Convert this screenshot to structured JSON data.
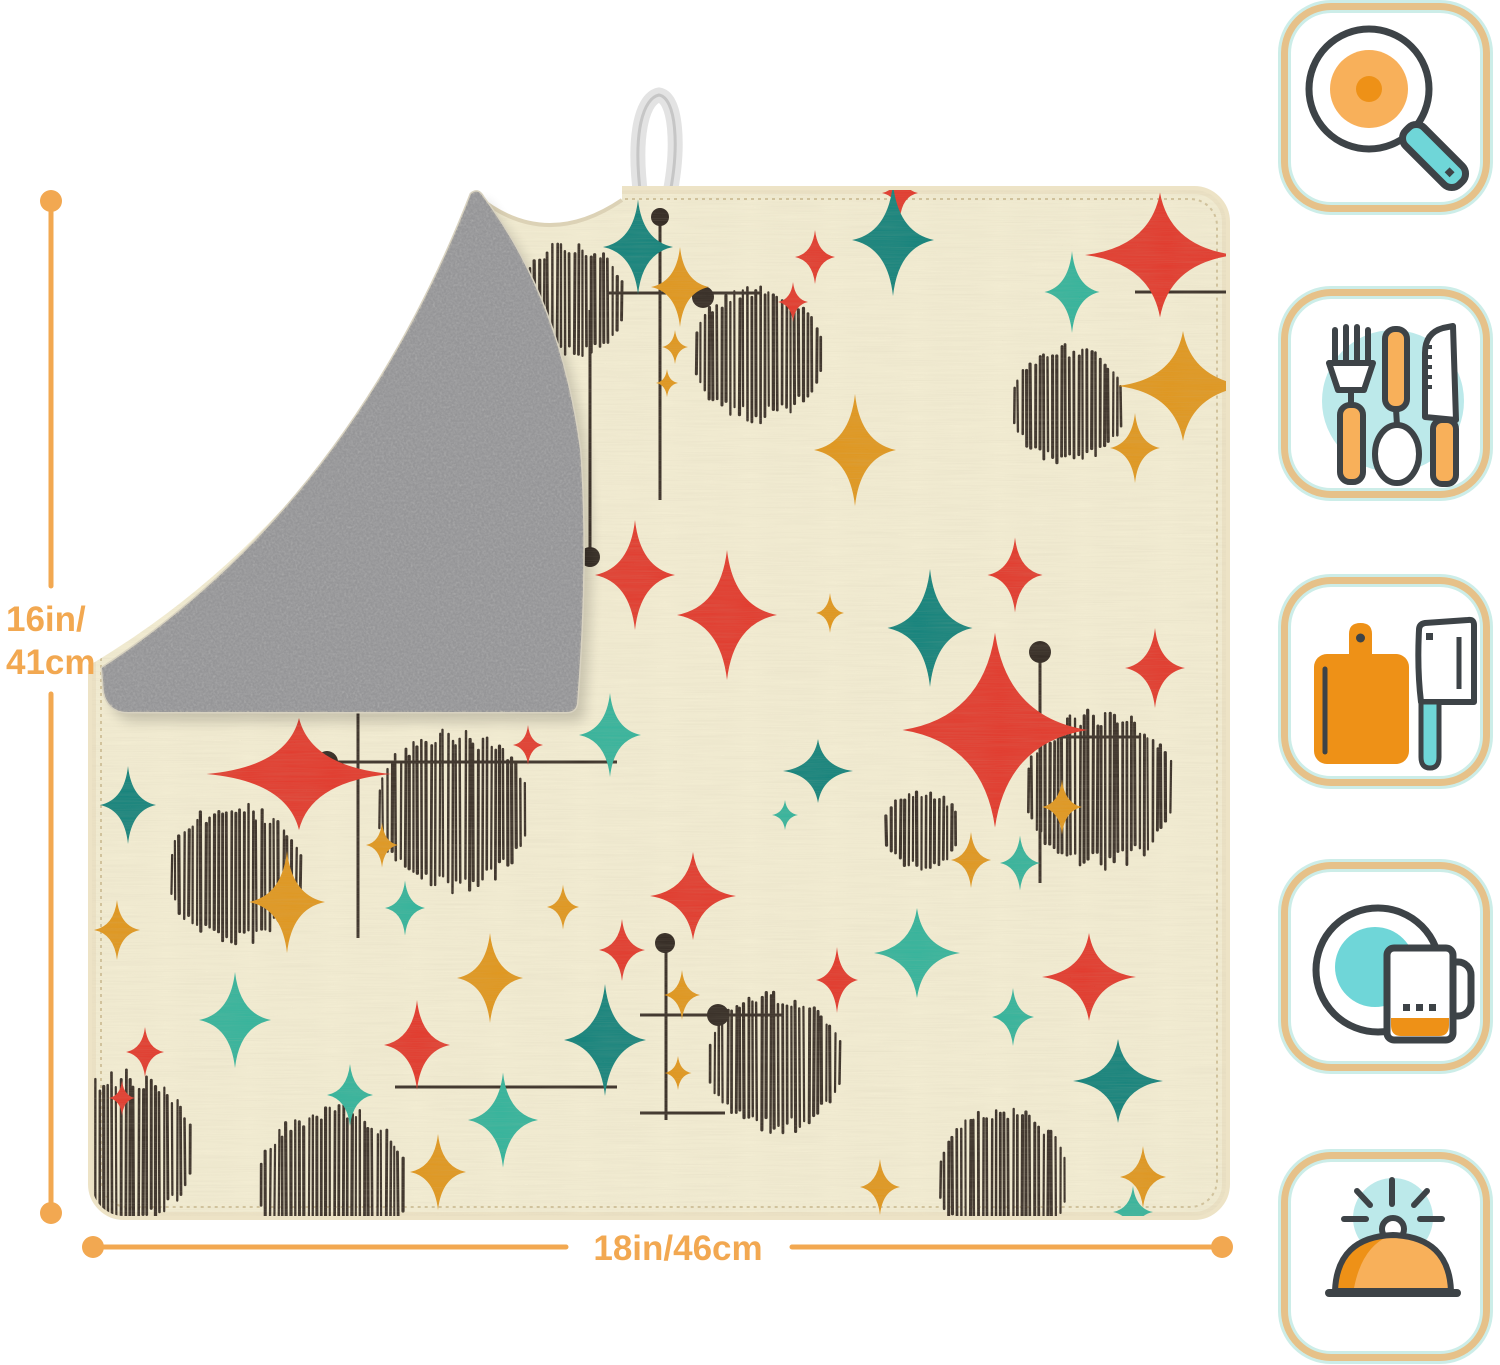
{
  "dimensions": {
    "height": {
      "line1": "16in/",
      "line2": "41cm"
    },
    "width": {
      "label": "18in/46cm"
    }
  },
  "colors": {
    "page_bg": "#FFFFFF",
    "dimension": "#F2A851",
    "mat_front": "#F3EDD3",
    "mat_edge": "#EDE3C6",
    "mat_stitch": "#C9B88E",
    "mat_back": "#B4B4B4",
    "loop": "#E3E3E3",
    "badge_border": "#E6C189",
    "badge_glow": "#CCEDE8",
    "icon_dark": "#3D4347",
    "icon_orange": "#EE9117",
    "icon_orange_light": "#F8B05A",
    "icon_teal": "#6FD6D8",
    "icon_teal_light": "#BCE9EA"
  },
  "pattern": {
    "colors": {
      "r": "#E23B2E",
      "t": "#15837C",
      "m": "#35B49C",
      "o": "#E0971F",
      "ink": "#3A3028",
      "dot": "#332A23"
    },
    "stars": [
      [
        638,
        247,
        70,
        95,
        "t"
      ],
      [
        900,
        193,
        36,
        50,
        "r"
      ],
      [
        815,
        257,
        40,
        54,
        "r"
      ],
      [
        793,
        302,
        30,
        40,
        "r"
      ],
      [
        893,
        240,
        82,
        112,
        "t"
      ],
      [
        1072,
        292,
        55,
        82,
        "m"
      ],
      [
        1160,
        255,
        150,
        125,
        "r"
      ],
      [
        1183,
        386,
        130,
        110,
        "o"
      ],
      [
        1135,
        448,
        50,
        70,
        "o"
      ],
      [
        855,
        450,
        82,
        112,
        "o"
      ],
      [
        680,
        287,
        58,
        80,
        "o"
      ],
      [
        675,
        347,
        26,
        34,
        "o"
      ],
      [
        667,
        383,
        22,
        28,
        "o"
      ],
      [
        635,
        575,
        80,
        110,
        "r"
      ],
      [
        727,
        615,
        100,
        130,
        "r"
      ],
      [
        830,
        613,
        28,
        40,
        "o"
      ],
      [
        930,
        628,
        85,
        118,
        "t"
      ],
      [
        1015,
        575,
        55,
        75,
        "r"
      ],
      [
        1155,
        668,
        60,
        80,
        "r"
      ],
      [
        299,
        774,
        185,
        112,
        "r"
      ],
      [
        128,
        805,
        56,
        78,
        "t"
      ],
      [
        117,
        930,
        46,
        60,
        "o"
      ],
      [
        287,
        902,
        76,
        102,
        "o"
      ],
      [
        382,
        845,
        32,
        45,
        "o"
      ],
      [
        405,
        908,
        40,
        55,
        "m"
      ],
      [
        528,
        745,
        30,
        40,
        "r"
      ],
      [
        610,
        735,
        62,
        84,
        "m"
      ],
      [
        563,
        907,
        32,
        45,
        "o"
      ],
      [
        490,
        978,
        66,
        90,
        "o"
      ],
      [
        417,
        1045,
        66,
        90,
        "r"
      ],
      [
        235,
        1020,
        72,
        96,
        "m"
      ],
      [
        145,
        1052,
        38,
        50,
        "r"
      ],
      [
        122,
        1098,
        26,
        35,
        "r"
      ],
      [
        350,
        1095,
        46,
        62,
        "m"
      ],
      [
        503,
        1120,
        70,
        95,
        "m"
      ],
      [
        438,
        1172,
        56,
        76,
        "o"
      ],
      [
        605,
        1040,
        82,
        112,
        "t"
      ],
      [
        622,
        950,
        46,
        62,
        "r"
      ],
      [
        995,
        730,
        185,
        195,
        "r"
      ],
      [
        818,
        771,
        70,
        64,
        "t"
      ],
      [
        785,
        815,
        26,
        30,
        "m"
      ],
      [
        693,
        896,
        86,
        88,
        "r"
      ],
      [
        682,
        995,
        36,
        50,
        "o"
      ],
      [
        678,
        1073,
        27,
        34,
        "o"
      ],
      [
        917,
        953,
        86,
        90,
        "m"
      ],
      [
        837,
        980,
        42,
        66,
        "r"
      ],
      [
        971,
        860,
        40,
        56,
        "o"
      ],
      [
        1020,
        863,
        40,
        55,
        "m"
      ],
      [
        1062,
        807,
        40,
        55,
        "o"
      ],
      [
        1089,
        977,
        94,
        88,
        "r"
      ],
      [
        1013,
        1017,
        42,
        58,
        "m"
      ],
      [
        1118,
        1081,
        90,
        84,
        "t"
      ],
      [
        1143,
        1177,
        46,
        62,
        "o"
      ],
      [
        1133,
        1212,
        40,
        52,
        "m"
      ],
      [
        880,
        1187,
        40,
        56,
        "o"
      ]
    ],
    "circles": [
      [
        758,
        353,
        65
      ],
      [
        1068,
        405,
        57
      ],
      [
        570,
        300,
        55
      ],
      [
        235,
        873,
        67
      ],
      [
        453,
        810,
        77
      ],
      [
        120,
        1150,
        75
      ],
      [
        333,
        1185,
        75
      ],
      [
        775,
        1062,
        68
      ],
      [
        922,
        830,
        38
      ],
      [
        1100,
        790,
        75
      ],
      [
        1003,
        1178,
        66
      ]
    ],
    "lines": [
      [
        660,
        217,
        660,
        500
      ],
      [
        608,
        293,
        762,
        293
      ],
      [
        590,
        310,
        590,
        555
      ],
      [
        1135,
        292,
        1226,
        292
      ],
      [
        327,
        762,
        617,
        762
      ],
      [
        358,
        705,
        358,
        938
      ],
      [
        395,
        1087,
        617,
        1087
      ],
      [
        640,
        1015,
        782,
        1015
      ],
      [
        666,
        945,
        666,
        1120
      ],
      [
        640,
        1113,
        725,
        1113
      ],
      [
        1040,
        652,
        1040,
        883
      ],
      [
        1000,
        737,
        1140,
        737
      ]
    ],
    "dots": [
      [
        660,
        217,
        9
      ],
      [
        703,
        297,
        11
      ],
      [
        590,
        557,
        10
      ],
      [
        327,
        762,
        11
      ],
      [
        665,
        943,
        10
      ],
      [
        718,
        1015,
        11
      ],
      [
        1040,
        652,
        11
      ],
      [
        1007,
        737,
        11
      ]
    ]
  },
  "sidebar_icons": [
    {
      "name": "frying-pan-search-icon"
    },
    {
      "name": "cutlery-icon"
    },
    {
      "name": "cutting-board-knife-icon"
    },
    {
      "name": "dish-and-mug-icon"
    },
    {
      "name": "serving-cloche-icon"
    }
  ]
}
